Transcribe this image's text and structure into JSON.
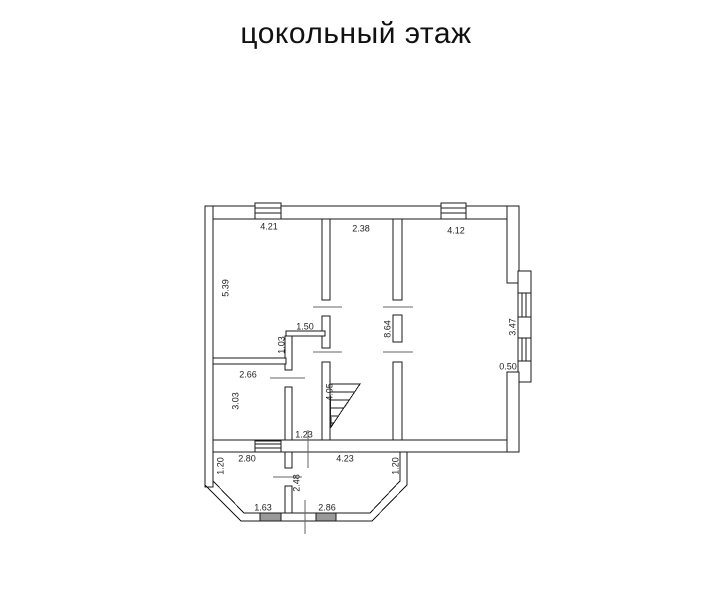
{
  "title": "цокольный этаж",
  "dimensions": {
    "room1_width": "4.21",
    "room2_width": "2.38",
    "room3_width": "4.12",
    "room1_height": "5.39",
    "hall_nook_width": "1.50",
    "hall_nook_height": "1.03",
    "center_wall_length": "8.64",
    "right_bay_span": "3.47",
    "right_bay_ledge": "0.50",
    "small_room_width": "2.66",
    "small_room_height": "3.03",
    "stair_run": "4.05",
    "bottom_opening_width": "1.23",
    "bay_room_left_width": "2.80",
    "bay_room_right_width": "4.23",
    "bay_side_left": "1.20",
    "bay_side_right": "1.20",
    "bay_center_wall_height": "2.48",
    "bay_window_left": "1.63",
    "bay_window_right": "2.86"
  },
  "colors": {
    "line": "#1a1a1a",
    "tick": "#666666",
    "window_fill": "#999999",
    "background": "#ffffff"
  }
}
